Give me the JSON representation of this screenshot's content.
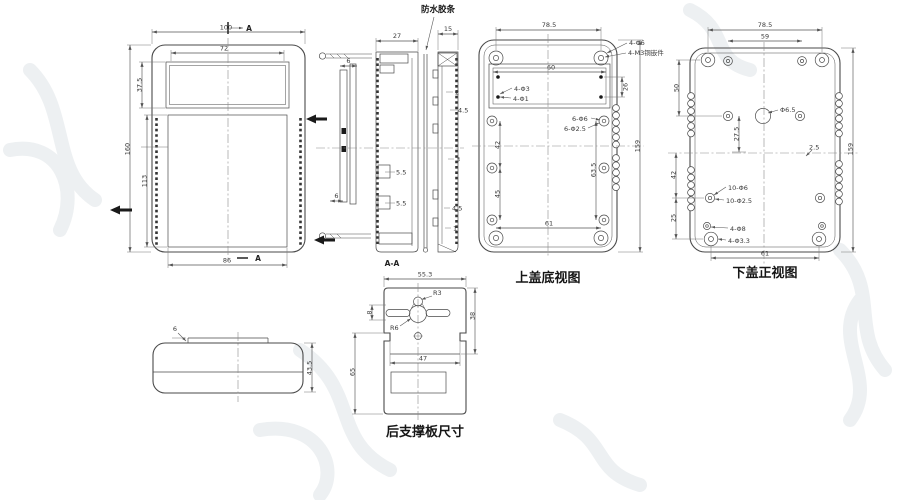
{
  "drawing": {
    "front_view": {
      "dim_width_top": "100",
      "dim_window_width": "72",
      "dim_window_height": "37.5",
      "dim_height_total": "160",
      "dim_height_body": "113",
      "dim_width_bottom": "86",
      "section_arrow_label_top": "A",
      "section_arrow_label_bottom": "A"
    },
    "side_view": {
      "gasket_label": "防水胶条",
      "dim_width_main": "27",
      "dim_width_right": "15",
      "dim_clip_top": "6",
      "dim_clip_bottom": "6",
      "dim_rib_a": "5.5",
      "dim_rib_b": "5.5",
      "dim_r1": "2",
      "dim_r2": "4.5",
      "dim_r3": "3",
      "dim_r4": "4.5",
      "dim_r5": "1",
      "section_label": "A-A"
    },
    "top_cover_view": {
      "title": "上盖底视图",
      "dim_top": "78.5",
      "dim_window": "60",
      "dim_window_height": "26",
      "dim_left_upper": "42",
      "dim_left_lower": "45",
      "dim_right_inner": "63.5",
      "dim_right_total": "159",
      "dim_bottom": "61",
      "callout_corner_a": "4-Φ6",
      "callout_corner_b": "4-M3铜嵌件",
      "callout_window_a": "4-Φ3",
      "callout_window_b": "4-Φ1",
      "callout_boss_a": "6-Φ6",
      "callout_boss_b": "6-Φ2.5"
    },
    "bottom_cover_view": {
      "title": "下盖正视图",
      "dim_top": "78.5",
      "dim_top_inner": "59",
      "dim_left_upper": "50",
      "dim_center_hole": "Φ6.5",
      "dim_mid": "27.5",
      "dim_offset": "2.5",
      "dim_left_mid": "42",
      "dim_left_lower": "25",
      "dim_right_total": "159",
      "dim_bottom": "61",
      "callout_boss_a": "10-Φ6",
      "callout_boss_b": "10-Φ2.5",
      "callout_corner_a": "4-Φ8",
      "callout_corner_b": "4-Φ3.3"
    },
    "profile_view": {
      "dim_step": "6",
      "dim_height": "43.5"
    },
    "support_plate_view": {
      "title": "后支撑板尺寸",
      "dim_width_top": "55.3",
      "radius_top": "R3",
      "radius_bottom": "R6",
      "dim_slot": "8",
      "dim_right": "38",
      "dim_mid_width": "47",
      "dim_left": "65"
    }
  }
}
